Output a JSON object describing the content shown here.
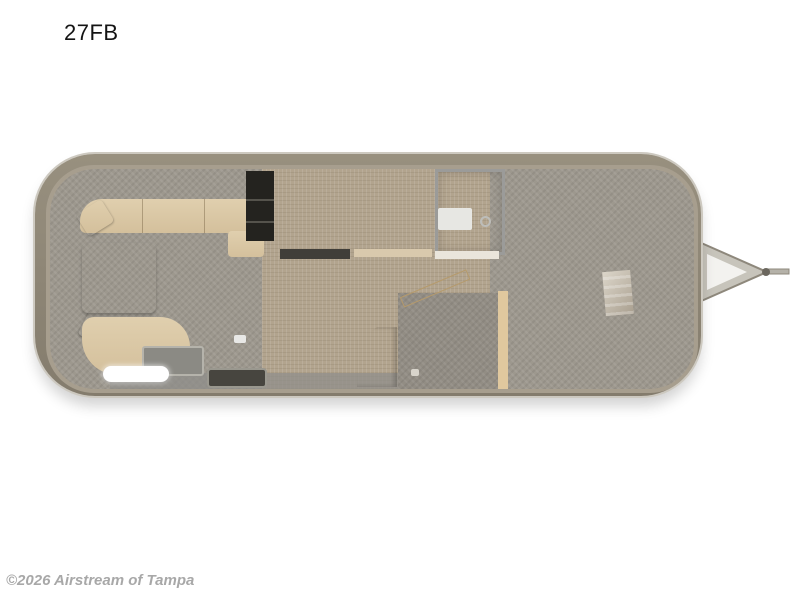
{
  "title": "27FB",
  "watermark": "©2026 Airstream of Tampa",
  "colors": {
    "background": "#ffffff",
    "shell": "#8b8375",
    "shell_outline": "#cdc9c0",
    "floor_vinyl": "#b2a48e",
    "carpet_gray": "#9d988e",
    "sofa_tan": "#d9c6a4",
    "cushion_gray": "#a6aaa7",
    "wood_light": "#f3ddb2",
    "counter_marble": "#a3a29e",
    "appliance_dark": "#282725",
    "fixture_white": "#f6f6f4",
    "window_tint": "#46423a",
    "watermark_gray": "#a8a8a8"
  },
  "floorplan": {
    "model": "27FB",
    "vehicle": "travel-trailer-floorplan",
    "hitch_side": "right",
    "fixtures": [
      "rear-wraparound-lounge",
      "accent-pillows",
      "ottoman-table",
      "refrigerator",
      "pantry-cabinet",
      "wardrobe-with-hangers",
      "shower",
      "kitchen-sink",
      "kitchen-counter",
      "cooktop-stove",
      "kitchen-cabinet",
      "bathroom-door",
      "toilet",
      "lavatory-sink",
      "queen-bed",
      "bed-pillows",
      "nightstand-posts",
      "entry-step",
      "roof-vents",
      "windows",
      "a-frame-hitch"
    ]
  }
}
